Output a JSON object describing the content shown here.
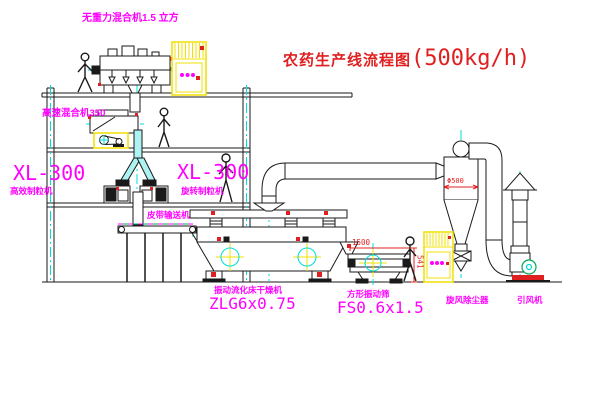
{
  "title": {
    "name": "农药生产线流程图",
    "capacity": "(500kg/h)"
  },
  "equipment_labels": {
    "gravity_mixer": "无重力混合机1.5 立方",
    "high_speed_mixer": "高速混合机350",
    "granulator_left_model": "XL-300",
    "granulator_left_name": "高效制粒机",
    "granulator_mid_model": "XL-300",
    "granulator_mid_name": "旋转制粒机",
    "belt_conveyor": "皮带输送机",
    "fluid_bed_dryer_name": "振动流化床干燥机",
    "fluid_bed_dryer_model": "ZLG6x0.75",
    "vibrating_screen_name": "方形振动筛",
    "vibrating_screen_model": "FS0.6x1.5",
    "cyclone_dust_collector": "旋风除尘器",
    "induced_draft_fan": "引风机"
  },
  "dimensions": {
    "screen_length": "1500",
    "screen_height": "541",
    "cyclone_diameter": "Φ500"
  },
  "colors": {
    "label_magenta": "#ff00ff",
    "annotation_red": "#e02020",
    "centerline_cyan": "#00dcdc",
    "highlight_yellow": "#f0e000",
    "line_black": "#1a1a1a",
    "motor_green": "#00a850"
  }
}
